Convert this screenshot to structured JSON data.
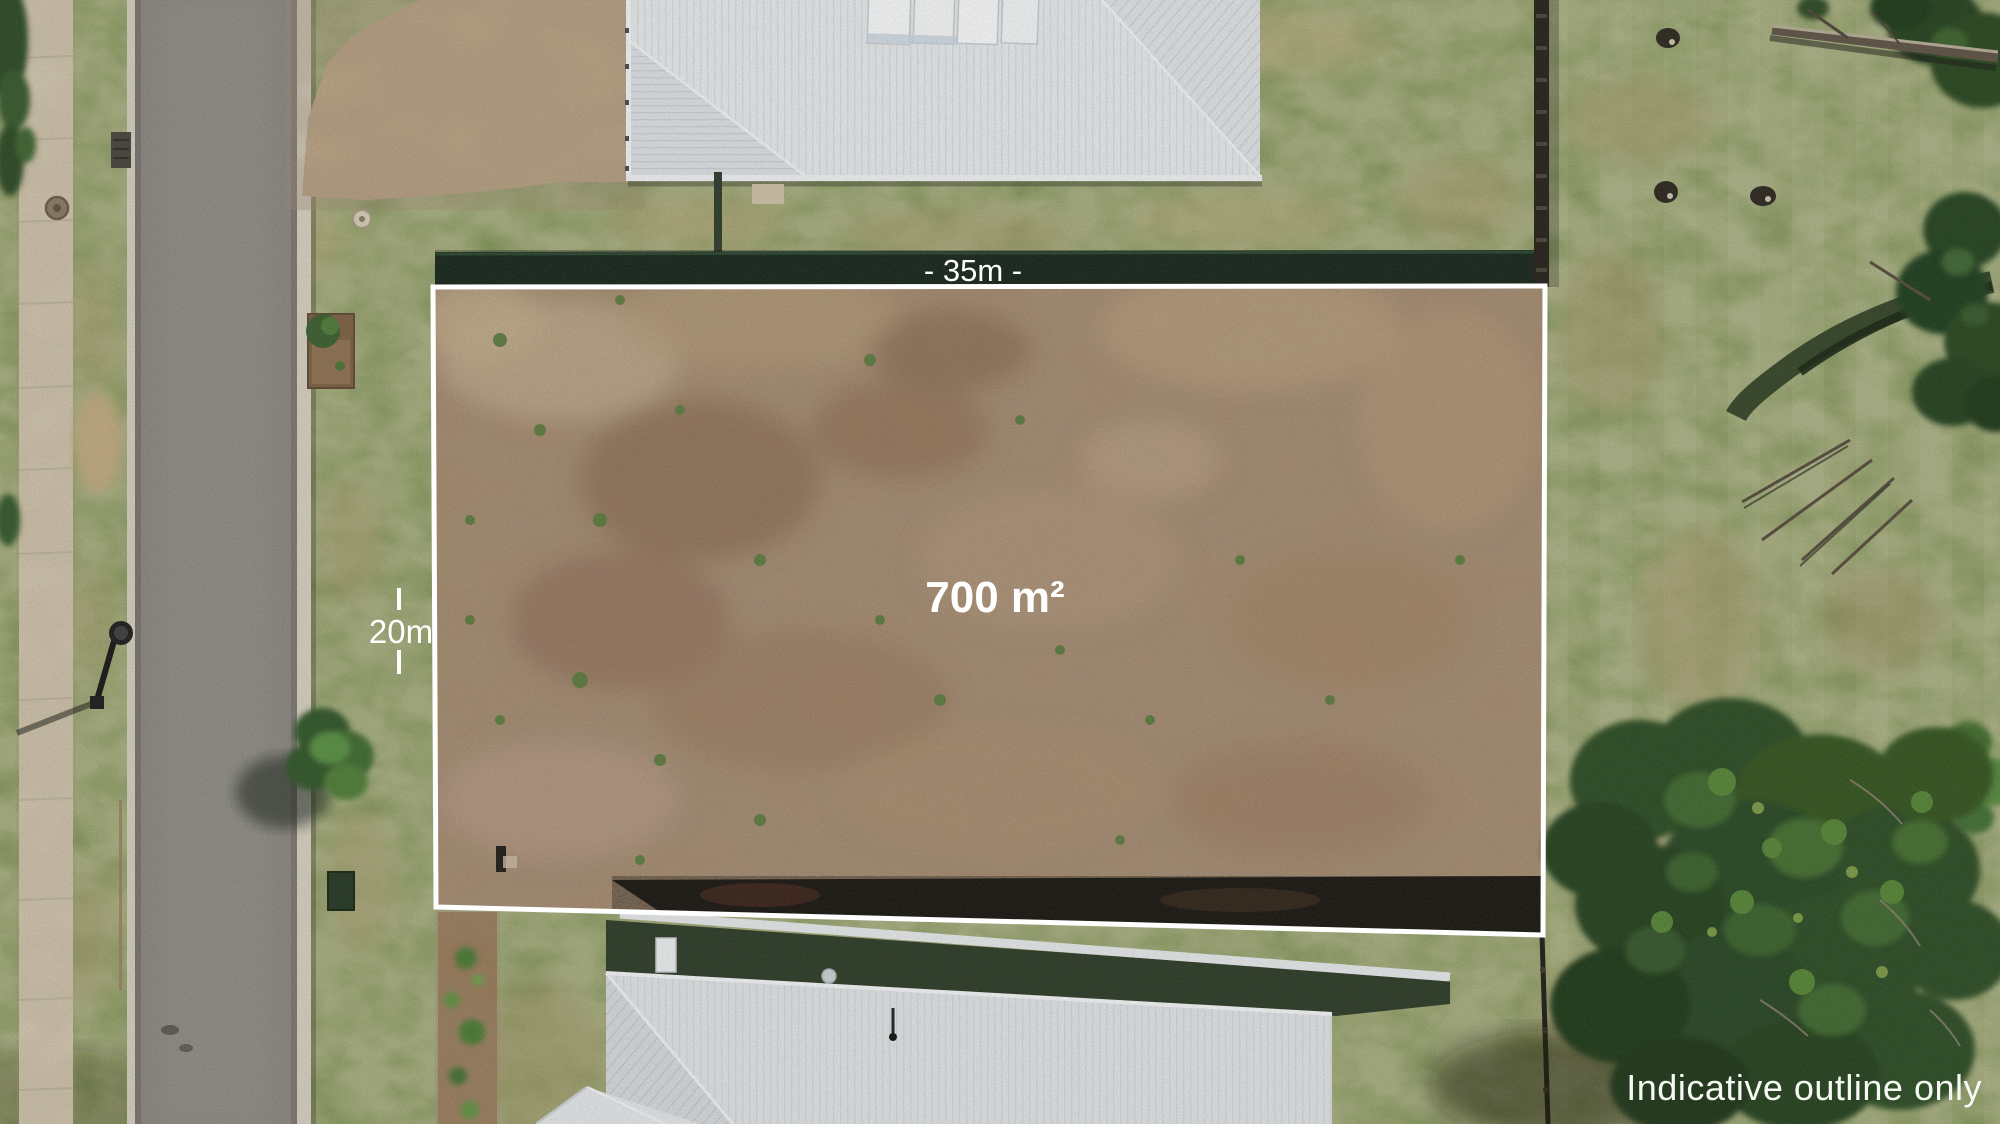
{
  "image": {
    "kind": "aerial-drone-photo",
    "subject": "vacant residential land lot with white indicative boundary overlay"
  },
  "annotations": {
    "width_label": "- 35m -",
    "depth_label": "20m",
    "area_label": "700 m²",
    "disclaimer": "Indicative outline only"
  },
  "measurements": {
    "frontage_m": 35,
    "depth_m": 20,
    "area_sqm": 700
  },
  "colors": {
    "outline": "#ffffff",
    "label_text": "#ffffff",
    "grass": "#7d9152",
    "dirt": "#a8896b",
    "road": "#8b8680",
    "sidewalk": "#d9ceb5",
    "roof": "#e9ecee",
    "hedge": "#1c3122",
    "tree": "#2c4b24"
  }
}
